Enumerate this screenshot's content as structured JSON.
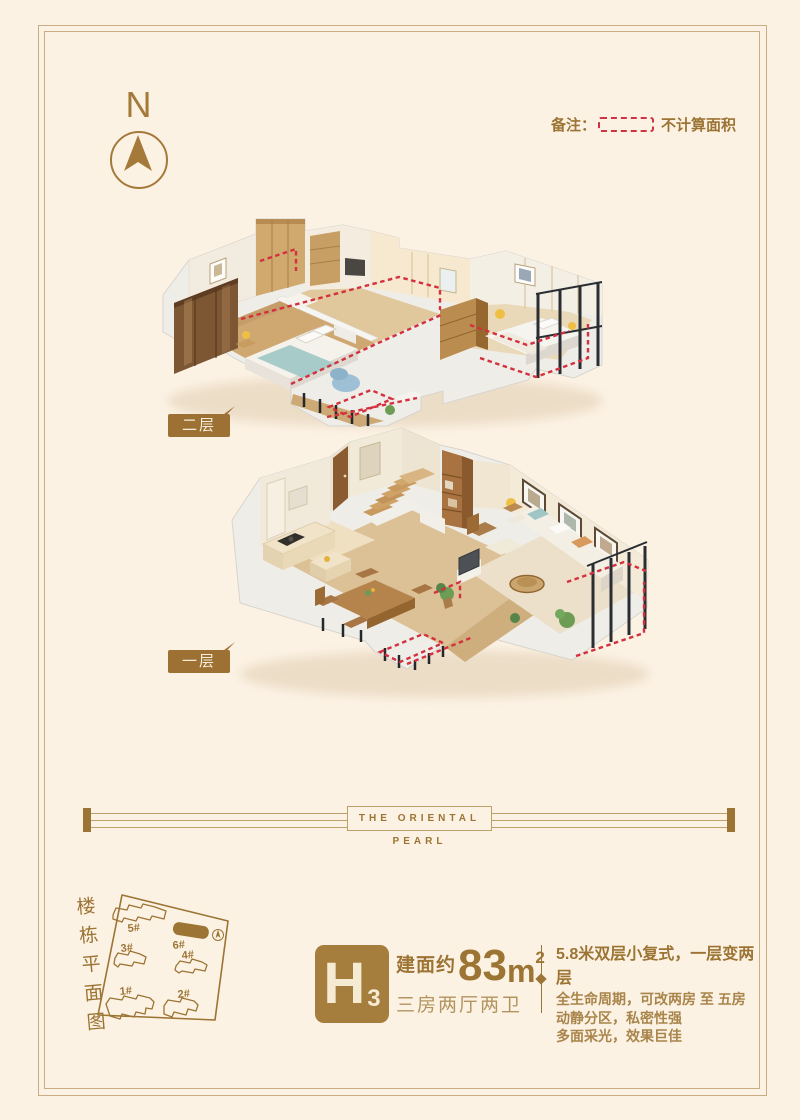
{
  "note": {
    "label": "备注：",
    "text": "不计算面积"
  },
  "compass": {
    "letter": "N"
  },
  "floors": {
    "upper": {
      "label": "二层"
    },
    "lower": {
      "label": "一层"
    }
  },
  "divider": {
    "text": "THE ORIENTAL PEARL"
  },
  "site_plan": {
    "title": "楼栋平面图",
    "buildings": [
      {
        "id": "5#"
      },
      {
        "id": "6#"
      },
      {
        "id": "3#"
      },
      {
        "id": "4#"
      },
      {
        "id": "1#"
      },
      {
        "id": "2#"
      }
    ],
    "highlighted": "6#"
  },
  "unit": {
    "code": "H",
    "code_sub": "3",
    "area_prefix": "建面约",
    "area_value": "83",
    "area_unit": "m",
    "area_sup": "2",
    "rooms": "三房两厅两卫"
  },
  "description": {
    "lines": [
      "5.8米双层小复式，一层变两层",
      "全生命周期，可改两房 至 五房",
      "动静分区，私密性强",
      "多面采光，效果巨佳"
    ]
  },
  "colors": {
    "accent": "#9c7434",
    "red": "#d4303e",
    "background": "#fcf2e4"
  }
}
